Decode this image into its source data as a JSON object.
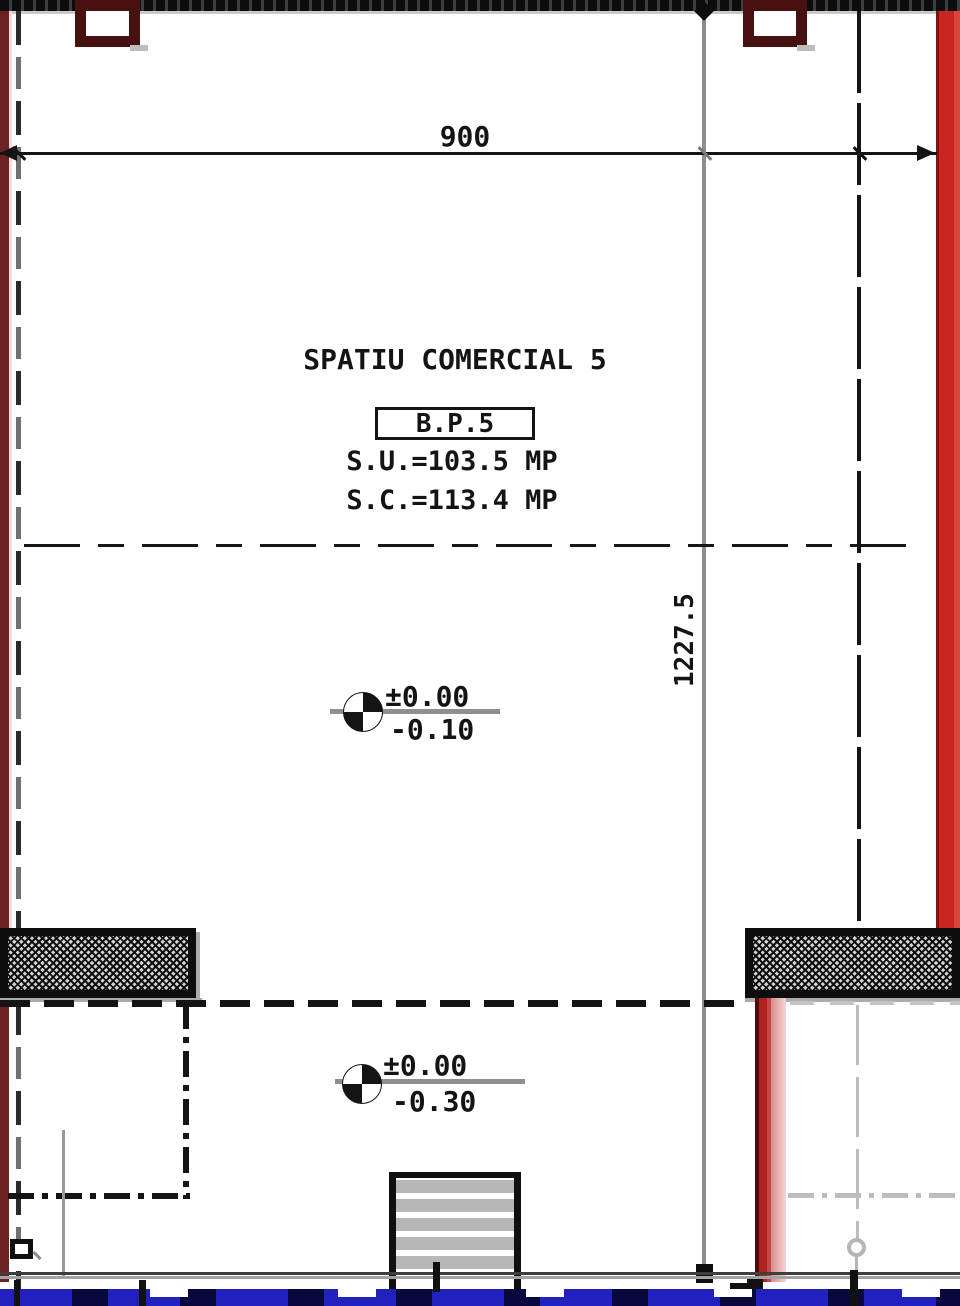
{
  "drawing": {
    "room_label": "SPATIU COMERCIAL 5",
    "unit_tag": "B.P.5",
    "area_usable": "S.U.=103.5 MP",
    "area_built": "S.C.=113.4 MP"
  },
  "dimensions": {
    "horizontal": "900",
    "vertical": "1227.5"
  },
  "levels": {
    "upper": {
      "above": "±0.00",
      "below": "-0.10"
    },
    "lower": {
      "above": "±0.00",
      "below": "-0.30"
    }
  },
  "colors": {
    "wall_maroon": "#6d2222",
    "column_maroon": "#471111",
    "wall_red": "#c92521",
    "wall_pink": "#e7aaa6",
    "axis_gray": "#8d8d8d",
    "hidden_gray": "#b5b5b5",
    "glazing_blue": "#2121bf",
    "ink": "#141414"
  }
}
